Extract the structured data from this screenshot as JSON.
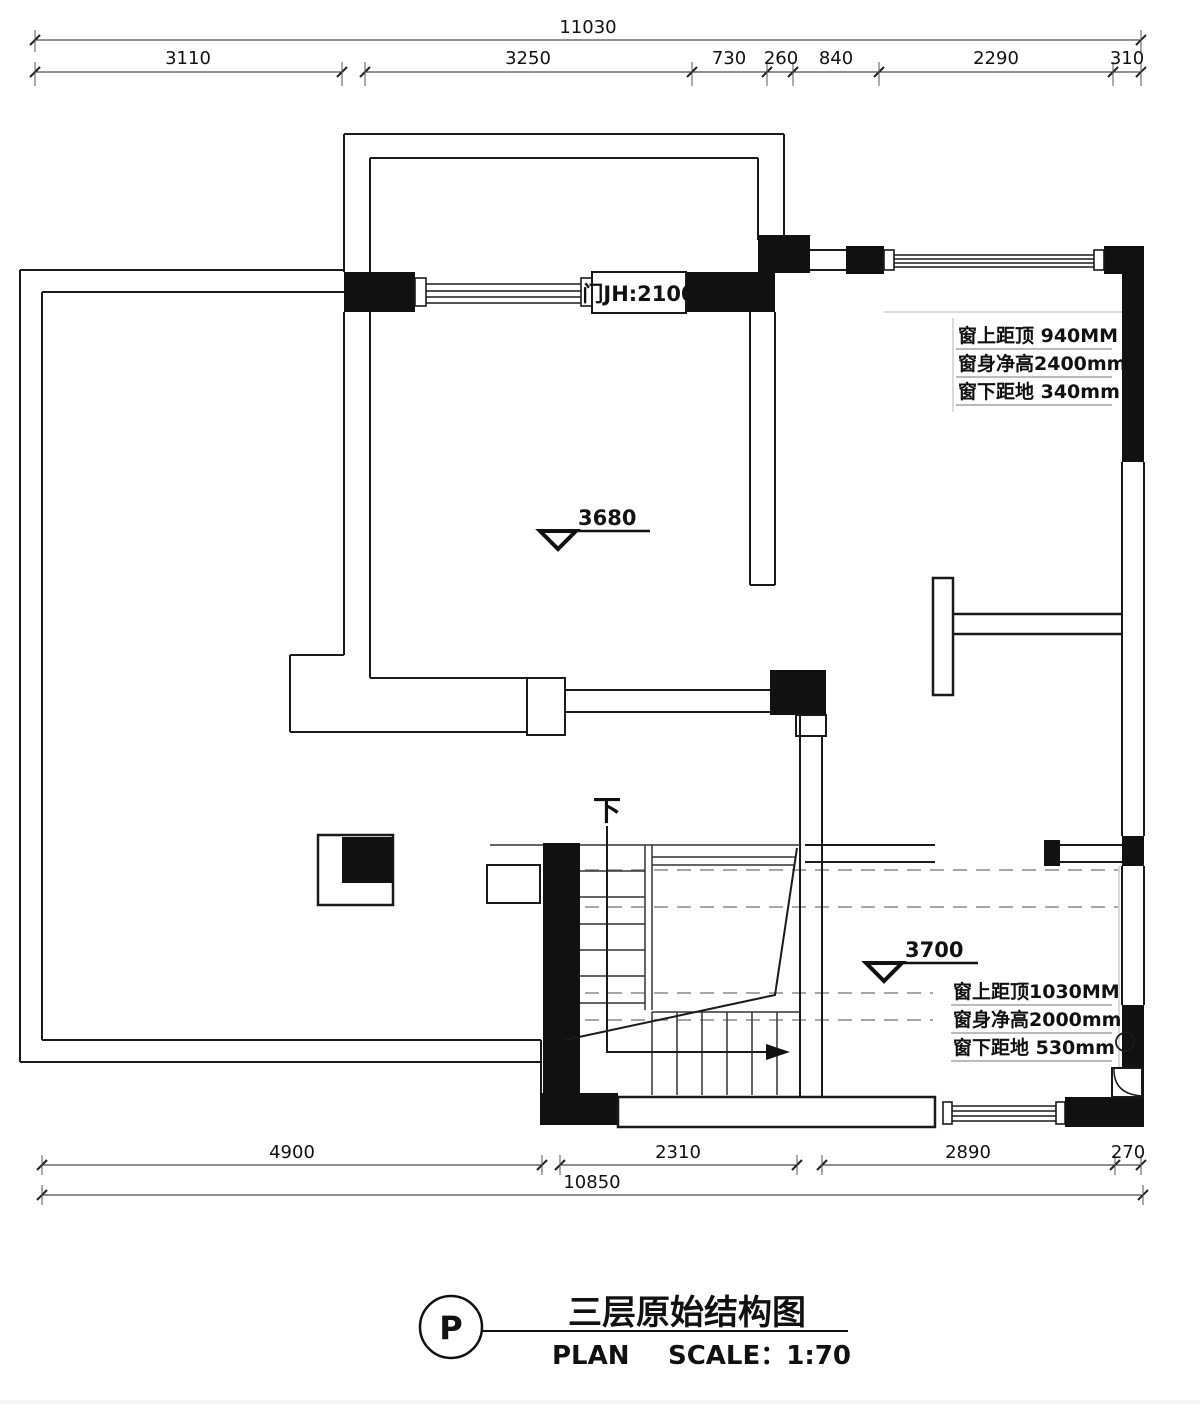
{
  "drawing": {
    "kind": "architectural floor plan",
    "floor": "third floor original structure"
  },
  "dimensions": {
    "top": {
      "overall": "11030",
      "segments": [
        "3110",
        "3250",
        "730",
        "260",
        "840",
        "2290",
        "310"
      ]
    },
    "bottom": {
      "segments": [
        "4900",
        "2310",
        "2890",
        "270"
      ],
      "overall": "10850"
    }
  },
  "annotations": {
    "door_label": "门JH:2100",
    "window_top_right": {
      "line1": "窗上距顶 940MM",
      "line2": "窗身净高2400mm",
      "line3": "窗下距地 340mm"
    },
    "window_bottom_right": {
      "line1": "窗上距顶1030MM",
      "line2": "窗身净高2000mm",
      "line3": "窗下距地 530mm"
    },
    "elevation_upper": "3680",
    "elevation_lower": "3700",
    "stair_direction": "下"
  },
  "title_block": {
    "ref_letter": "P",
    "title": "三层原始结构图",
    "plan_label": "PLAN",
    "scale_label": "SCALE：1:70"
  },
  "colors": {
    "line": "#1a1a1a",
    "wall_fill": "#111111",
    "dashed_beam": "#8a8a8a",
    "background": "#ffffff"
  }
}
